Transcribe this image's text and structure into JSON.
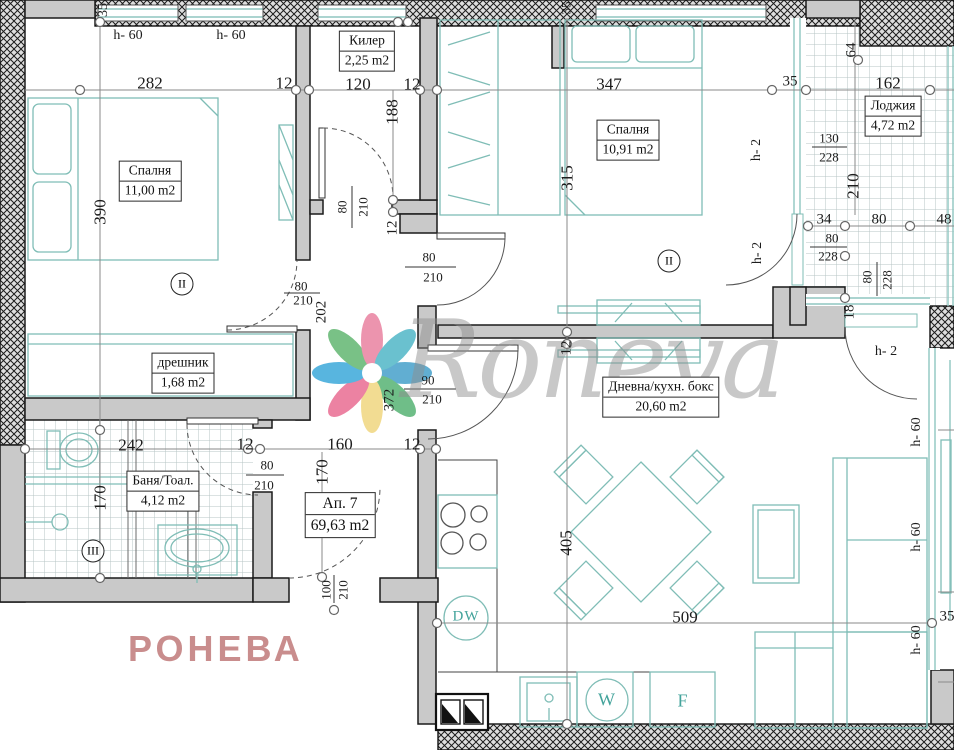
{
  "plan": {
    "watermark_script": "Roneva",
    "watermark_caps": "РОНЕВА",
    "colors": {
      "wall_gray": "#c9c9c9",
      "hatch_line": "#1c1c1c",
      "furniture_teal": "#7fbdb6",
      "appliance_teal": "#43a39b",
      "tile_grid": "#b7c4c4",
      "dim_line": "#8a8a8a",
      "watermark_pink": "#c98d8d",
      "watermark_gray": "#8e8e8e"
    }
  },
  "rooms": [
    {
      "name": "bedroom-1",
      "label": "Спалня",
      "area": "11,00 m2",
      "x": 150,
      "y": 181,
      "fs": 13.5
    },
    {
      "name": "kiler",
      "label": "Килер",
      "area": "2,25 m2",
      "x": 367,
      "y": 51,
      "fs": 13.5
    },
    {
      "name": "bedroom-2",
      "label": "Спалня",
      "area": "10,91 m2",
      "x": 628,
      "y": 140,
      "fs": 13.5
    },
    {
      "name": "loggia",
      "label": "Лоджия",
      "area": "4,72 m2",
      "x": 893,
      "y": 116,
      "fs": 13.5
    },
    {
      "name": "dreshnik",
      "label": "дрешник",
      "area": "1,68 m2",
      "x": 183,
      "y": 373,
      "fs": 13.5
    },
    {
      "name": "bathroom",
      "label": "Баня/Тоал.",
      "area": "4,12 m2",
      "x": 163,
      "y": 491,
      "fs": 13.5
    },
    {
      "name": "apartment-number",
      "label": "Ап. 7",
      "area": "69,63 m2",
      "x": 340,
      "y": 515,
      "fs": 15.5
    },
    {
      "name": "living-kitchen",
      "label": "Дневна/кухн. бокс",
      "area": "20,60 m2",
      "x": 661,
      "y": 397,
      "fs": 13.5
    }
  ],
  "axis_marks": [
    {
      "name": "axis-mark-II-bedroom1",
      "text": "II",
      "x": 182,
      "y": 284
    },
    {
      "name": "axis-mark-II-bedroom2",
      "text": "II",
      "x": 669,
      "y": 261
    },
    {
      "name": "axis-mark-III-bath",
      "text": "III",
      "x": 93,
      "y": 551
    }
  ],
  "appliances": [
    {
      "name": "dishwasher-label",
      "text": "DW",
      "x": 466,
      "y": 617,
      "fs": 15
    },
    {
      "name": "washer-label",
      "text": "W",
      "x": 607,
      "y": 700,
      "fs": 18
    },
    {
      "name": "fridge-label",
      "text": "F",
      "x": 683,
      "y": 701,
      "fs": 18
    }
  ],
  "labels": [
    {
      "name": "dim-35-top-left",
      "text": "35",
      "x": 104,
      "y": 10,
      "fs": 14,
      "rot": 1
    },
    {
      "name": "note-h60-window-1",
      "text": "h- 60",
      "x": 128,
      "y": 36,
      "fs": 14
    },
    {
      "name": "note-h60-window-2",
      "text": "h- 60",
      "x": 231,
      "y": 36,
      "fs": 14
    },
    {
      "name": "dim-282",
      "text": "282",
      "x": 150,
      "y": 83,
      "fs": 17
    },
    {
      "name": "dim-12-1",
      "text": "12",
      "x": 284,
      "y": 83,
      "fs": 17
    },
    {
      "name": "dim-120",
      "text": "120",
      "x": 358,
      "y": 84,
      "fs": 17
    },
    {
      "name": "dim-12-2",
      "text": "12",
      "x": 412,
      "y": 84,
      "fs": 17
    },
    {
      "name": "dim-35-top-mid",
      "text": "35",
      "x": 566,
      "y": 8,
      "fs": 13,
      "rot": 1
    },
    {
      "name": "dim-347",
      "text": "347",
      "x": 609,
      "y": 84,
      "fs": 17
    },
    {
      "name": "dim-35-2",
      "text": "35",
      "x": 790,
      "y": 82,
      "fs": 15
    },
    {
      "name": "dim-162",
      "text": "162",
      "x": 888,
      "y": 83,
      "fs": 17
    },
    {
      "name": "dim-64",
      "text": "64",
      "x": 852,
      "y": 50,
      "fs": 15,
      "rot": 1
    },
    {
      "name": "dim-390",
      "text": "390",
      "x": 100,
      "y": 212,
      "fs": 17,
      "rot": 1
    },
    {
      "name": "dim-188",
      "text": "188",
      "x": 392,
      "y": 112,
      "fs": 17,
      "rot": 1
    },
    {
      "name": "dim-315",
      "text": "315",
      "x": 567,
      "y": 178,
      "fs": 17,
      "rot": 1
    },
    {
      "name": "dim-210-loggia",
      "text": "210",
      "x": 853,
      "y": 186,
      "fs": 17,
      "rot": 1
    },
    {
      "name": "dim-130",
      "text": "130",
      "x": 829,
      "y": 138,
      "fs": 13
    },
    {
      "name": "dim-228-1",
      "text": "228",
      "x": 829,
      "y": 157,
      "fs": 13
    },
    {
      "name": "note-h2-1",
      "text": "h- 2",
      "x": 757,
      "y": 150,
      "fs": 14,
      "rot": 1
    },
    {
      "name": "dim-34",
      "text": "34",
      "x": 824,
      "y": 220,
      "fs": 15
    },
    {
      "name": "dim-80-1",
      "text": "80",
      "x": 879,
      "y": 220,
      "fs": 15
    },
    {
      "name": "dim-48",
      "text": "48",
      "x": 944,
      "y": 220,
      "fs": 15
    },
    {
      "name": "dim-80-2",
      "text": "80",
      "x": 832,
      "y": 238,
      "fs": 13
    },
    {
      "name": "dim-228-2",
      "text": "228",
      "x": 828,
      "y": 256,
      "fs": 13
    },
    {
      "name": "dim-80-3",
      "text": "80",
      "x": 867,
      "y": 277,
      "fs": 13,
      "rot": 1
    },
    {
      "name": "dim-228-3",
      "text": "228",
      "x": 887,
      "y": 280,
      "fs": 13,
      "rot": 1
    },
    {
      "name": "note-h2-2",
      "text": "h- 2",
      "x": 758,
      "y": 253,
      "fs": 14,
      "rot": 1
    },
    {
      "name": "dim-18",
      "text": "18",
      "x": 850,
      "y": 312,
      "fs": 15,
      "rot": 1
    },
    {
      "name": "note-h2-3",
      "text": "h- 2",
      "x": 886,
      "y": 352,
      "fs": 14
    },
    {
      "name": "dim-80-kiler",
      "text": "80",
      "x": 342,
      "y": 207,
      "fs": 13,
      "rot": 1
    },
    {
      "name": "dim-210-kiler",
      "text": "210",
      "x": 363,
      "y": 207,
      "fs": 13,
      "rot": 1
    },
    {
      "name": "dim-12-3",
      "text": "12",
      "x": 393,
      "y": 228,
      "fs": 15,
      "rot": 1
    },
    {
      "name": "dim-202",
      "text": "202",
      "x": 322,
      "y": 312,
      "fs": 15,
      "rot": 1
    },
    {
      "name": "dim-80-4",
      "text": "80",
      "x": 301,
      "y": 286,
      "fs": 13
    },
    {
      "name": "dim-210-4",
      "text": "210",
      "x": 303,
      "y": 300,
      "fs": 13
    },
    {
      "name": "dim-80-5",
      "text": "80",
      "x": 429,
      "y": 257,
      "fs": 13
    },
    {
      "name": "dim-210-5",
      "text": "210",
      "x": 433,
      "y": 277,
      "fs": 13
    },
    {
      "name": "dim-90",
      "text": "90",
      "x": 428,
      "y": 380,
      "fs": 13
    },
    {
      "name": "dim-210-6",
      "text": "210",
      "x": 432,
      "y": 399,
      "fs": 13
    },
    {
      "name": "dim-372",
      "text": "372",
      "x": 390,
      "y": 400,
      "fs": 15,
      "rot": 1
    },
    {
      "name": "dim-12-4",
      "text": "12",
      "x": 567,
      "y": 348,
      "fs": 15,
      "rot": 1
    },
    {
      "name": "dim-242",
      "text": "242",
      "x": 131,
      "y": 445,
      "fs": 17
    },
    {
      "name": "dim-12-5",
      "text": "12",
      "x": 245,
      "y": 444,
      "fs": 17
    },
    {
      "name": "dim-160",
      "text": "160",
      "x": 340,
      "y": 444,
      "fs": 17
    },
    {
      "name": "dim-12-6",
      "text": "12",
      "x": 412,
      "y": 444,
      "fs": 17
    },
    {
      "name": "dim-80-bath",
      "text": "80",
      "x": 267,
      "y": 465,
      "fs": 13
    },
    {
      "name": "dim-210-bath",
      "text": "210",
      "x": 264,
      "y": 485,
      "fs": 13
    },
    {
      "name": "dim-170-bath",
      "text": "170",
      "x": 100,
      "y": 498,
      "fs": 17,
      "rot": 1
    },
    {
      "name": "dim-170-hall",
      "text": "170",
      "x": 322,
      "y": 472,
      "fs": 17,
      "rot": 1
    },
    {
      "name": "dim-100-entry",
      "text": "100",
      "x": 326,
      "y": 590,
      "fs": 13,
      "rot": 1
    },
    {
      "name": "dim-210-entry",
      "text": "210",
      "x": 343,
      "y": 590,
      "fs": 13,
      "rot": 1
    },
    {
      "name": "dim-405",
      "text": "405",
      "x": 566,
      "y": 543,
      "fs": 17,
      "rot": 1
    },
    {
      "name": "dim-509",
      "text": "509",
      "x": 685,
      "y": 617,
      "fs": 17
    },
    {
      "name": "dim-35-right",
      "text": "35",
      "x": 947,
      "y": 617,
      "fs": 15
    },
    {
      "name": "note-h60-r1",
      "text": "h- 60",
      "x": 917,
      "y": 432,
      "fs": 14,
      "rot": 1
    },
    {
      "name": "note-h60-r2",
      "text": "h- 60",
      "x": 917,
      "y": 537,
      "fs": 14,
      "rot": 1
    },
    {
      "name": "note-h60-r3",
      "text": "h- 60",
      "x": 917,
      "y": 640,
      "fs": 14,
      "rot": 1
    }
  ]
}
